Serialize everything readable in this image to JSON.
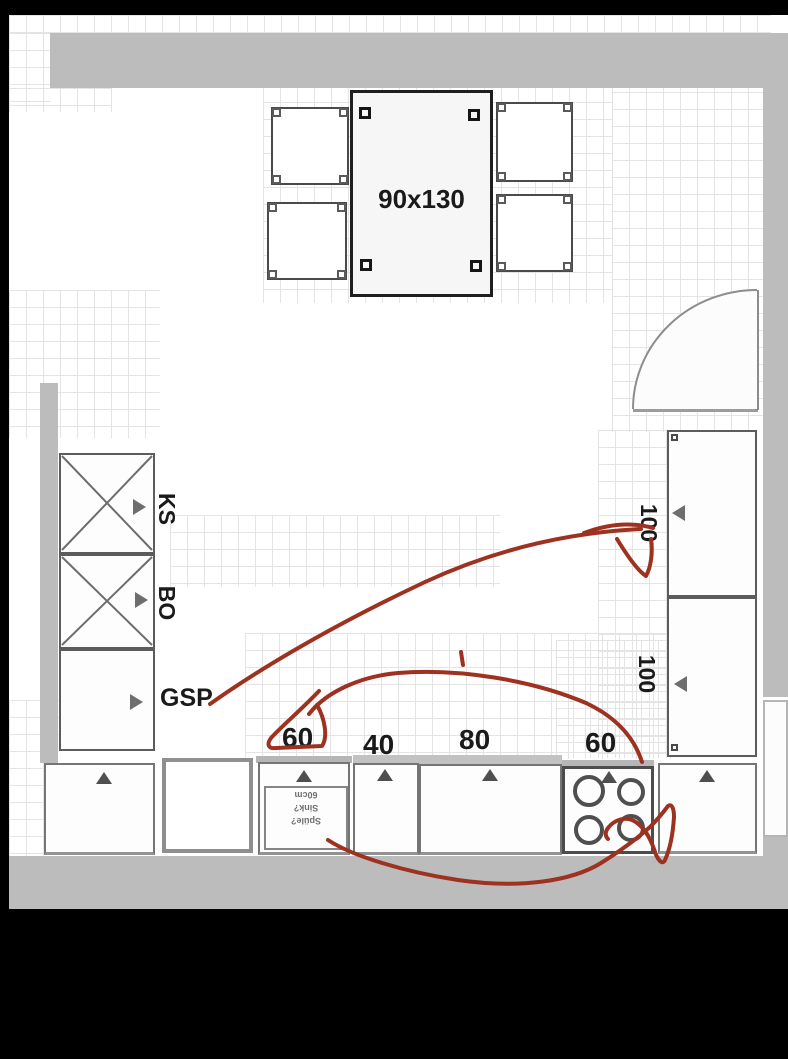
{
  "plan": {
    "table_label": "90x130",
    "left_column": {
      "cab1": "KS",
      "cab2": "BO",
      "cab3": "GSP"
    },
    "right_column": {
      "cab1": "100",
      "cab2": "100"
    },
    "base_row": {
      "sink": "60",
      "cab40": "40",
      "cab80": "80",
      "cooktop": "60"
    },
    "sink_note": {
      "line1": "Spüle?",
      "line2": "Sink?",
      "line3": "60cm"
    }
  },
  "colors": {
    "wall": "#bcbcbc",
    "annotation_red": "#9d3220",
    "grid": "#e4e4e4",
    "label_ink": "#1a1a1a"
  }
}
